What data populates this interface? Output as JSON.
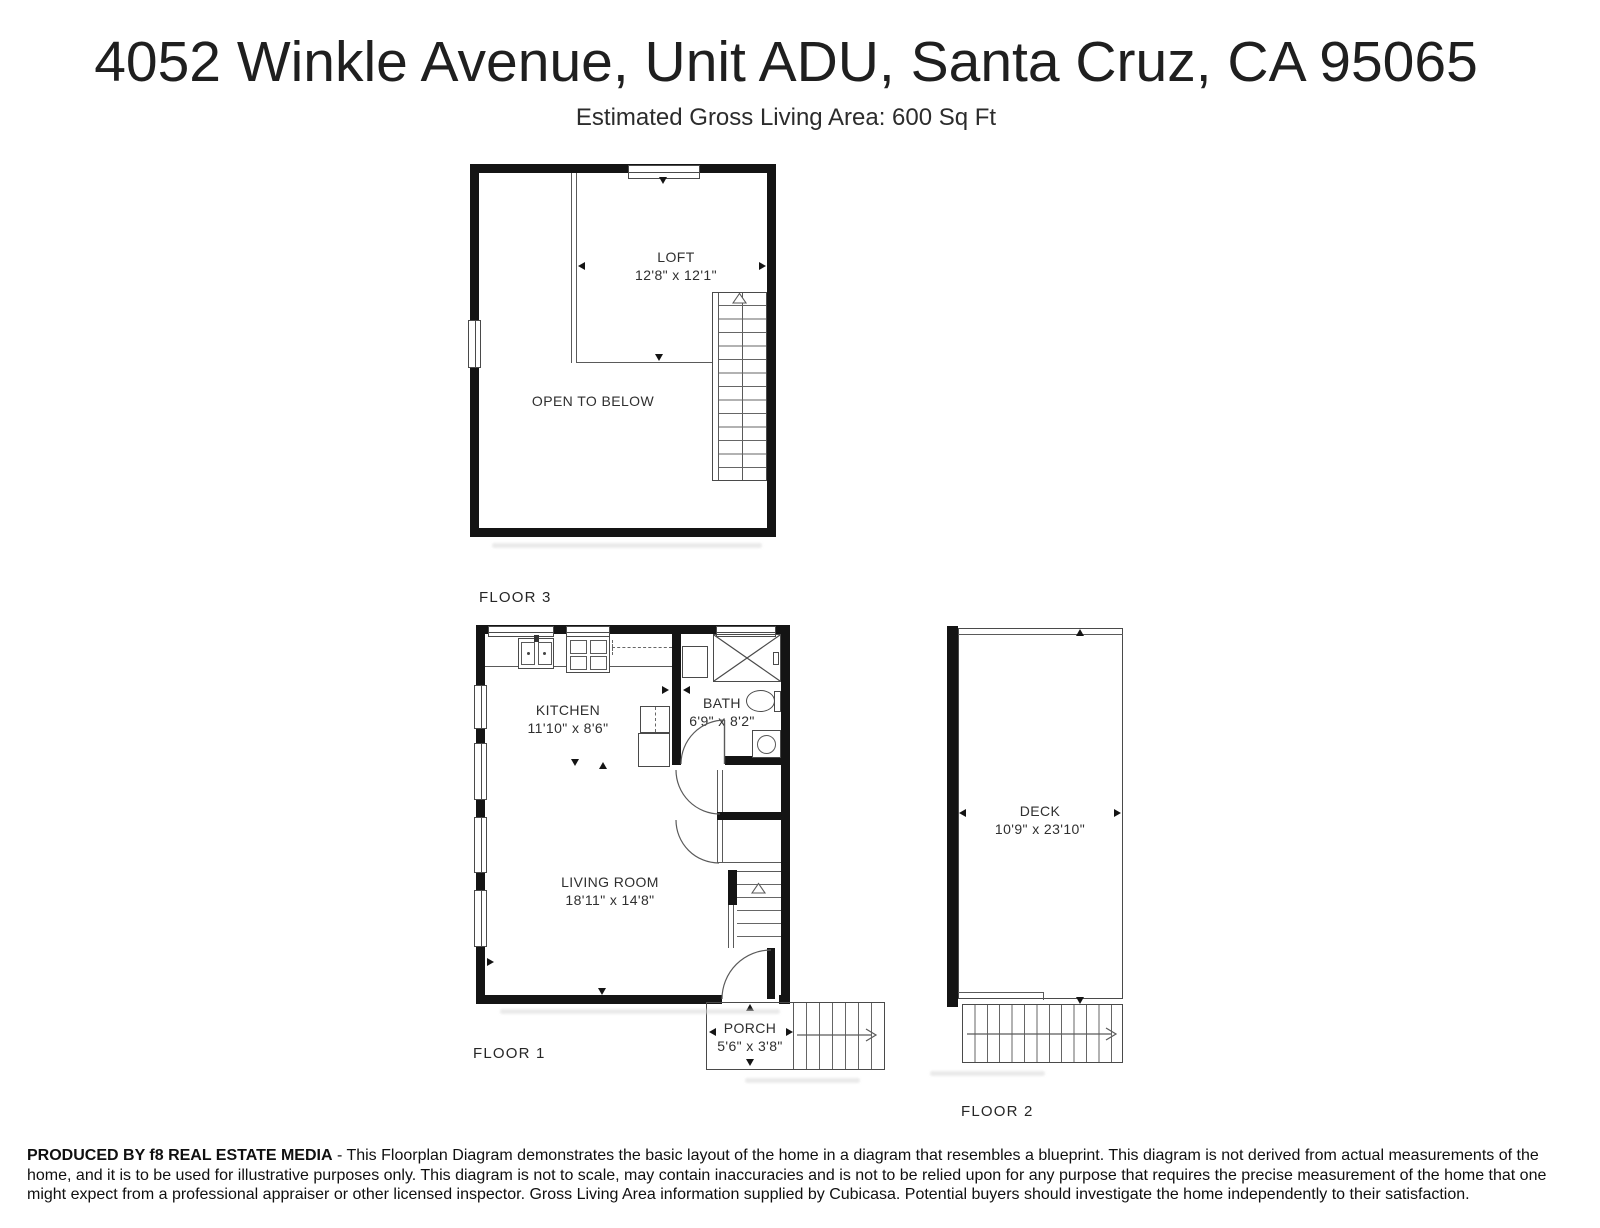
{
  "header": {
    "title": "4052 Winkle Avenue, Unit ADU, Santa Cruz, CA 95065",
    "subtitle": "Estimated Gross Living Area: 600 Sq Ft"
  },
  "floor3": {
    "label": "FLOOR 3",
    "loft": {
      "name": "LOFT",
      "dims": "12'8\" x 12'1\""
    },
    "open_to_below": "OPEN TO BELOW"
  },
  "floor1": {
    "label": "FLOOR 1",
    "kitchen": {
      "name": "KITCHEN",
      "dims": "11'10\" x 8'6\""
    },
    "bath": {
      "name": "BATH",
      "dims": "6'9\" x 8'2\""
    },
    "living_room": {
      "name": "LIVING ROOM",
      "dims": "18'11\" x 14'8\""
    },
    "porch": {
      "name": "PORCH",
      "dims": "5'6\" x 3'8\""
    }
  },
  "floor2": {
    "label": "FLOOR 2",
    "deck": {
      "name": "DECK",
      "dims": "10'9\" x 23'10\""
    }
  },
  "footer": {
    "producer": "PRODUCED BY f8 REAL ESTATE MEDIA",
    "disclaimer": " - This Floorplan Diagram demonstrates the basic layout of the home in a diagram that resembles a blueprint. This diagram is not derived from actual measurements of the home, and it is to be used for illustrative purposes only. This diagram is not to scale, may contain inaccuracies and is not to be relied upon for any purpose that requires the precise measurement of the home that one might expect from a professional appraiser or other licensed inspector. Gross Living Area information supplied by Cubicasa. Potential buyers should investigate the home independently to their satisfaction."
  },
  "colors": {
    "wall": "#141414",
    "line": "#5a5a5a",
    "text": "#2f2f2f"
  }
}
